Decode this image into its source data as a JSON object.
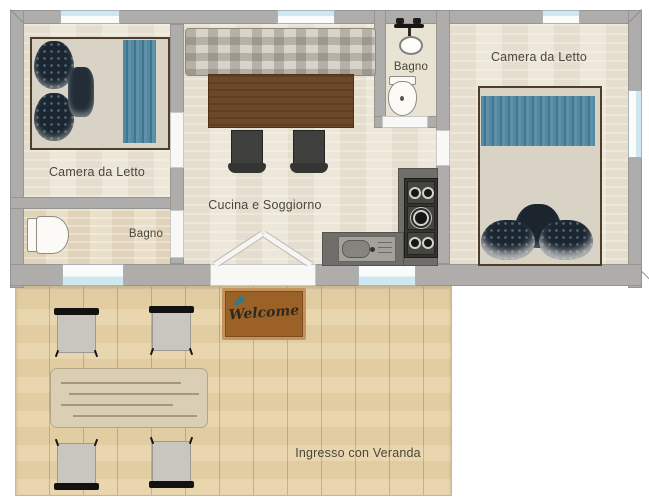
{
  "floorplan": {
    "rooms": {
      "bedroom_left": {
        "label": "Camera da Letto"
      },
      "bathroom_left": {
        "label": "Bagno"
      },
      "kitchen_living": {
        "label": "Cucina e Soggiorno"
      },
      "bathroom_top": {
        "label": "Bagno"
      },
      "bedroom_right": {
        "label": "Camera da Letto"
      },
      "veranda": {
        "label": "Ingresso con Veranda"
      }
    },
    "doormat": {
      "text": "Welcome"
    },
    "colors": {
      "wall": "#aeadab",
      "floor": "#ede7da",
      "deck_wood": "#e7d3a9",
      "accent_teal": "#477e97",
      "mat_brown": "#9c6127",
      "counter_gray": "#6f6e6a",
      "window_glass": "#cfe7f0"
    }
  }
}
